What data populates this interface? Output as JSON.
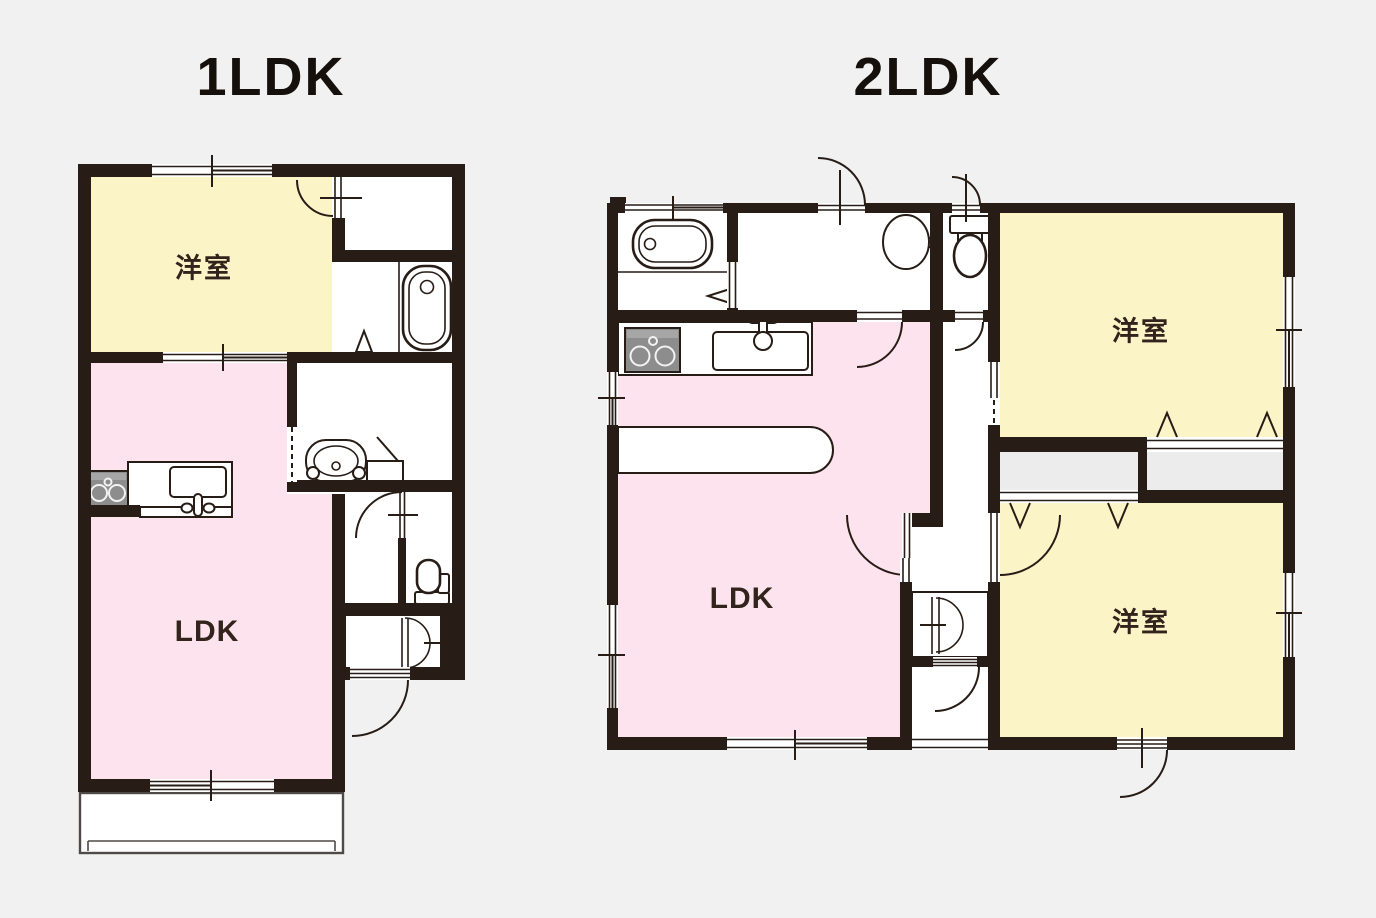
{
  "canvas": {
    "background": "#f1f1f1"
  },
  "palette": {
    "background": "#f1f1f1",
    "wall": "#271c16",
    "line": "#271c16",
    "room-yellow": "#fbf4c6",
    "room-pink": "#fde3ee",
    "closet-gray": "#ececec",
    "appliance-gray": "#8d8d8d",
    "appliance-gray-light": "#a6a6a6",
    "text": "#16100d",
    "label": "#32241c"
  },
  "plans": [
    {
      "id": "1ldk",
      "title": "1LDK",
      "rooms": [
        {
          "label": "洋室",
          "type": "western-room"
        },
        {
          "label": "LDK",
          "type": "living-dining-kitchen"
        }
      ],
      "fixtures": [
        "bathtub",
        "wash-basin",
        "washing-machine-pan",
        "toilet",
        "kitchen-stove",
        "kitchen-sink",
        "closet-double-door",
        "balcony",
        "entrance-door"
      ]
    },
    {
      "id": "2ldk",
      "title": "2LDK",
      "rooms": [
        {
          "label": "洋室",
          "type": "western-room"
        },
        {
          "label": "洋室",
          "type": "western-room"
        },
        {
          "label": "LDK",
          "type": "living-dining-kitchen"
        }
      ],
      "fixtures": [
        "bathtub",
        "wash-basin",
        "toilet",
        "kitchen-stove",
        "kitchen-sink",
        "kitchen-counter",
        "closet-sliding",
        "closet-sliding",
        "shoe-closet-double-door",
        "entrance-door"
      ]
    }
  ]
}
